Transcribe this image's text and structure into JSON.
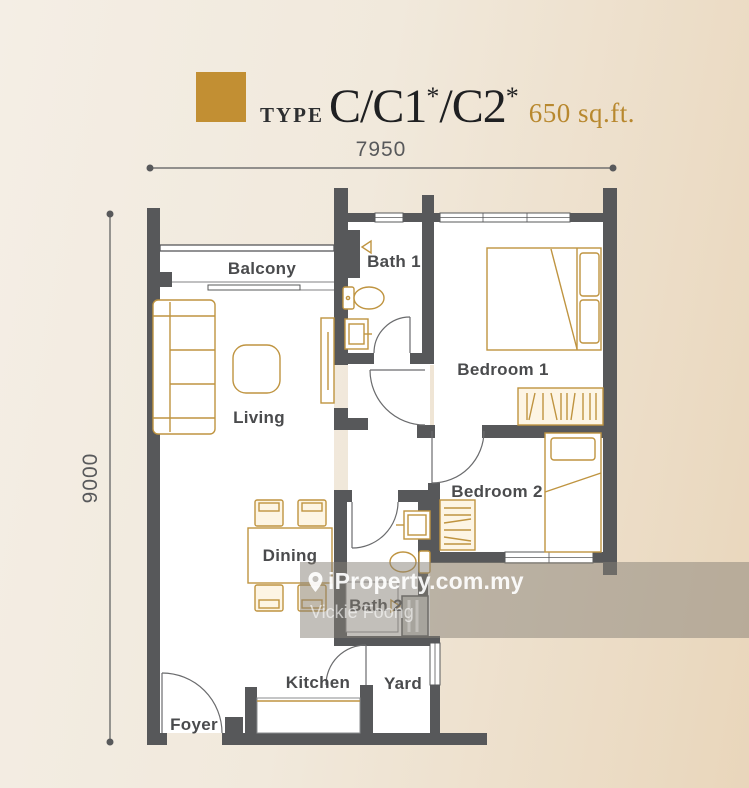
{
  "title": {
    "prefix": "TYPE",
    "main_parts": [
      "C/C1",
      "*",
      "/C2",
      "*"
    ],
    "area": "650 sq.ft."
  },
  "dimensions": {
    "width_label": "7950",
    "height_label": "9000"
  },
  "rooms": {
    "balcony": {
      "label": "Balcony"
    },
    "living": {
      "label": "Living"
    },
    "dining": {
      "label": "Dining"
    },
    "kitchen": {
      "label": "Kitchen"
    },
    "foyer": {
      "label": "Foyer"
    },
    "yard": {
      "label": "Yard"
    },
    "bath1": {
      "label": "Bath 1"
    },
    "bath2": {
      "label": "Bath 2"
    },
    "bedroom1": {
      "label": "Bedroom 1"
    },
    "bedroom2": {
      "label": "Bedroom 2"
    }
  },
  "watermark": {
    "brand": "iProperty.com.my",
    "agent": "Vickie Foong"
  },
  "colors": {
    "gold": "#bf9440",
    "wall": "#57585a",
    "cream": "#fdf5e4",
    "ink": "#4a4b4d",
    "swatch": "#c28f33",
    "title-gold": "#b8882e",
    "dim": "#58595b",
    "bg1": "#f4eee5",
    "bg2": "#e9d6bb",
    "wm-text": "#ffffff"
  }
}
